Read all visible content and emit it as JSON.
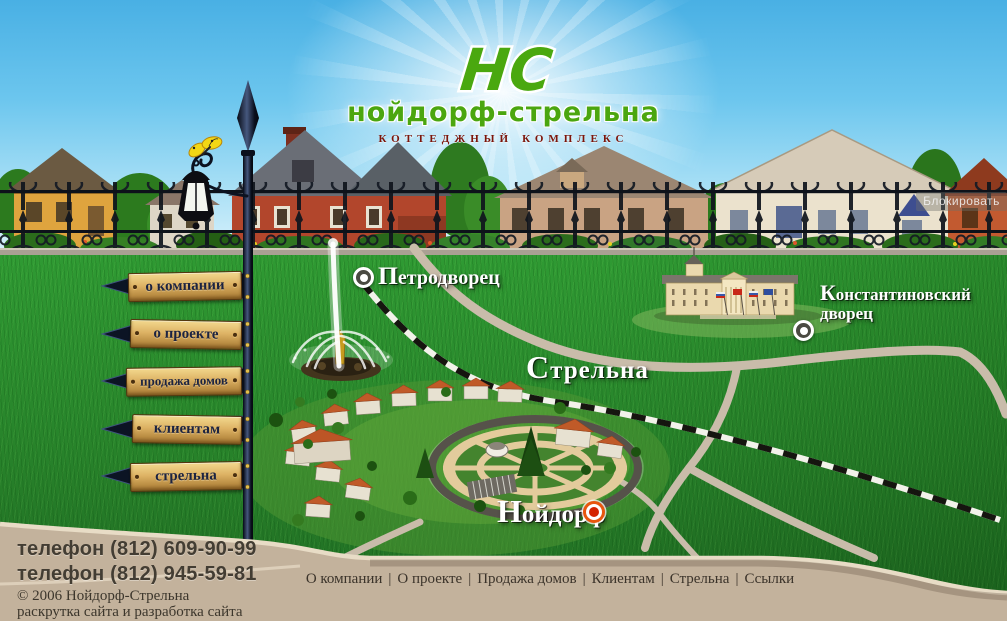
{
  "logo": {
    "monogram": "НС",
    "title": "нойдорф-стрельна",
    "subtitle": "коттеджный комплекс"
  },
  "menu": {
    "items": [
      {
        "label": "о компании"
      },
      {
        "label": "о проекте"
      },
      {
        "label": "продажа домов"
      },
      {
        "label": "клиентам"
      },
      {
        "label": "стрельна"
      }
    ]
  },
  "map": {
    "labels": {
      "petrodvorets": "Петродворец",
      "konstantinovsky_line1": "Константиновский",
      "konstantinovsky_line2": "дворец",
      "strelna": "Стрельна",
      "neudorf": "Нойдорф"
    }
  },
  "overlay": {
    "watermark": "Блокировать"
  },
  "footer": {
    "phone1": "телефон (812) 609-90-99",
    "phone2": "телефон (812) 945-59-81",
    "copyright": "© 2006 Нойдорф-Стрельна",
    "credits": {
      "link1": "раскрутка сайта",
      "separator": " и ",
      "link2": "разработка сайта"
    },
    "nav": [
      {
        "label": "О компании"
      },
      {
        "label": "О проекте"
      },
      {
        "label": "Продажа домов"
      },
      {
        "label": "Клиентам"
      },
      {
        "label": "Стрельна"
      },
      {
        "label": "Ссылки"
      }
    ],
    "nav_separator": "|"
  },
  "colors": {
    "sky_top": "#49b0e4",
    "grass_green": "#2f9a33",
    "footer_tan": "#c3b29c",
    "logo_green": "#4ba60f",
    "subtitle_red": "#7c150a",
    "sign_wood": "#ddb264",
    "neudorf_marker": "#e8560e"
  }
}
